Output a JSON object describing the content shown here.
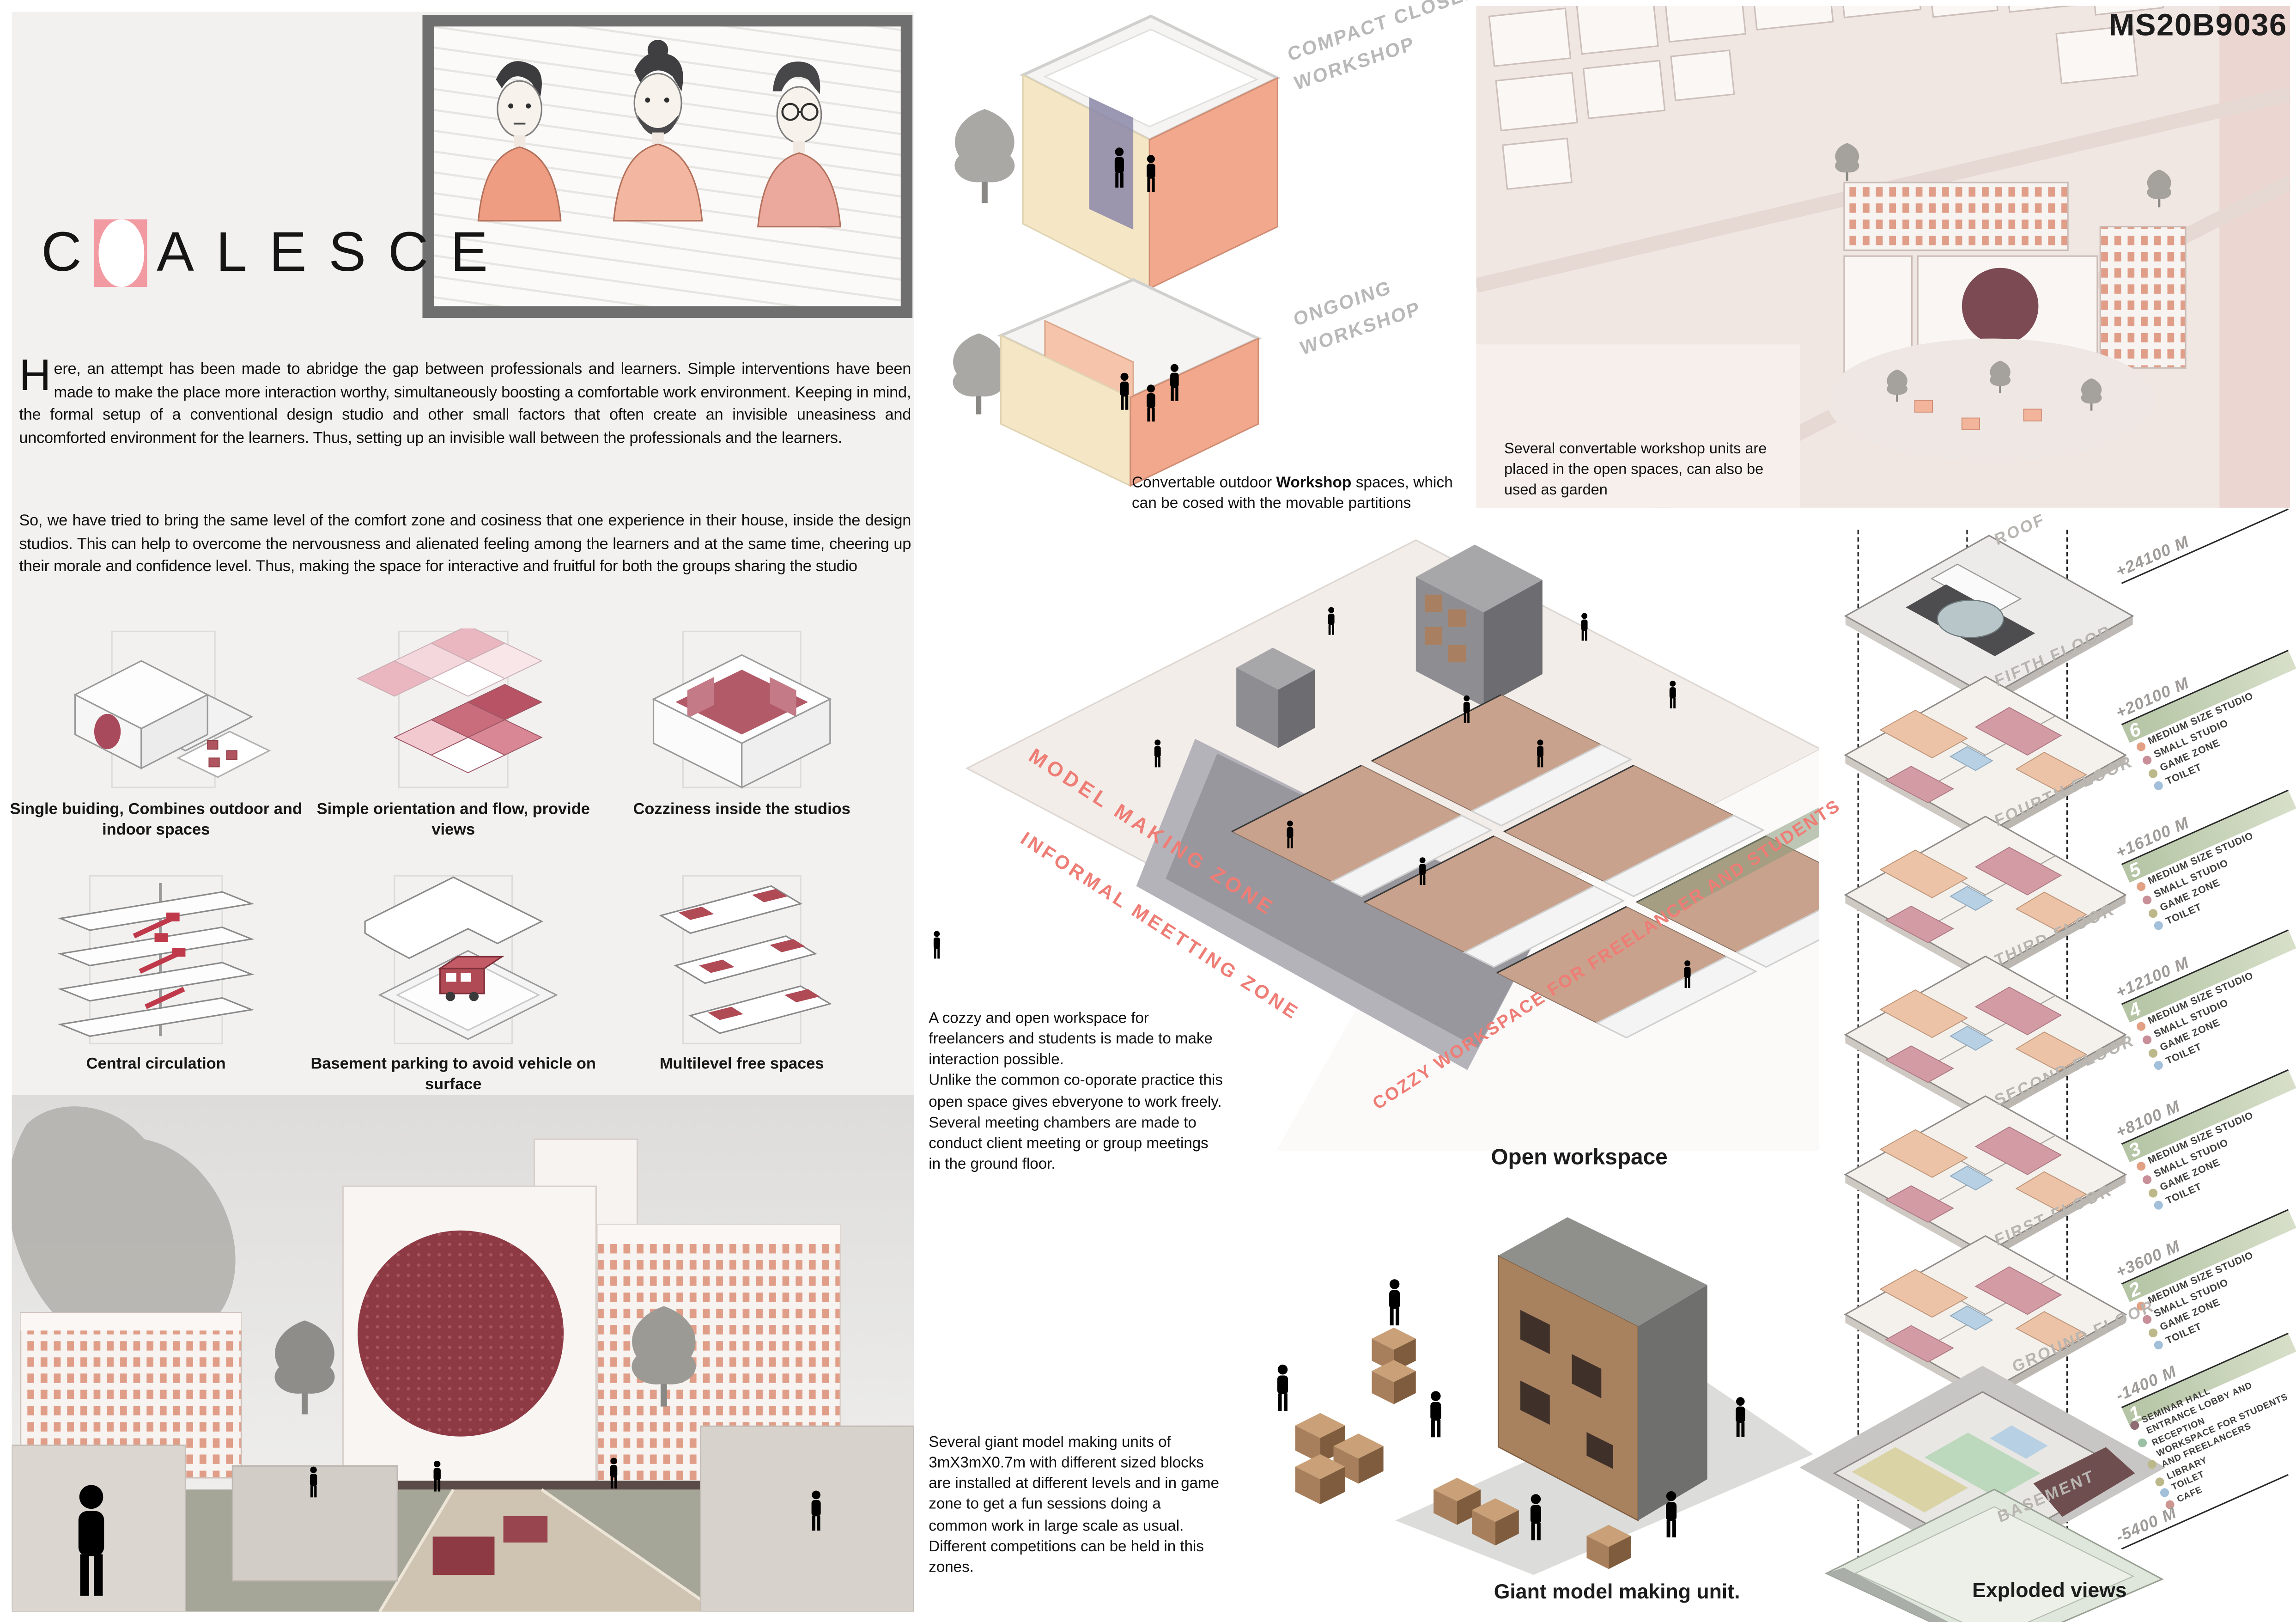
{
  "board": {
    "code": "MS20B9036"
  },
  "logo": {
    "first_letter": "C",
    "rest": "ALESCE"
  },
  "intro": {
    "drop_cap": "H",
    "p1": "ere, an attempt has been made to abridge the gap between professionals and learners. Simple interventions have been made to make the place more interaction worthy, simultaneously boosting a comfortable work environment. Keeping in mind, the formal setup of a conventional design studio and other small factors that often create an invisible uneasiness and uncomforted environment for the learners. Thus, setting up an invisible wall between the professionals and the learners.",
    "p2": "So, we have tried to bring the same level of the comfort zone and cosiness that one experience in their house, inside the design studios. This can help to overcome the nervousness and alienated feeling among the learners and at the same time, cheering up their morale and confidence level. Thus, making the space for interactive and fruitful for both the groups sharing the studio"
  },
  "concept_diagrams": [
    {
      "caption": "Single buiding, Combines outdoor and indoor spaces"
    },
    {
      "caption": "Simple orientation and flow, provide views"
    },
    {
      "caption": "Cozziness inside the studios"
    },
    {
      "caption": "Central circulation"
    },
    {
      "caption": "Basement parking to avoid vehicle on surface"
    },
    {
      "caption": "Multilevel free spaces"
    }
  ],
  "workshop": {
    "label_closed": "COMPACT CLOSED WORKSHOP",
    "label_ongoing": "ONGOING WORKSHOP",
    "caption_pre": "Convertable outdoor ",
    "caption_bold": "Workshop",
    "caption_post": " spaces, which can be cosed with the movable partitions"
  },
  "site": {
    "caption": "Several convertable workshop units are placed in the open spaces, can also be used as garden"
  },
  "open_workspace": {
    "title": "Open workspace",
    "caption": "A cozzy and open workspace for freelancers and students is made to make interaction possible.\nUnlike the common co-oporate practice this open space gives ebveryone to work freely. Several meeting chambers are made to conduct client meeting or group meetings in the ground floor.",
    "zones": {
      "model": "MODEL MAKING ZONE",
      "informal": "INFORMAL MEETTING ZONE",
      "cozzy": "COZZY WORKSPACE FOR FREELANCER AND STUDENTS"
    }
  },
  "model_unit": {
    "title": "Giant model making unit.",
    "caption": "Several giant model making units of 3mX3mX0.7m with different sized blocks are installed at different levels and in game zone to get a fun sessions doing a common work in large scale as usual.    Different competitions can be held in this zones."
  },
  "exploded": {
    "title": "Exploded views",
    "levels": [
      {
        "name": "ROOF",
        "elevation": "+24100 M",
        "number": "",
        "legend": []
      },
      {
        "name": "FIFTH FLOOR",
        "elevation": "+20100 M",
        "number": "6",
        "legend": [
          "MEDIUM SIZE STUDIO",
          "SMALL STUDIO",
          "GAME ZONE",
          "TOILET"
        ]
      },
      {
        "name": "FOURTH FLOOR",
        "elevation": "+16100 M",
        "number": "5",
        "legend": [
          "MEDIUM SIZE STUDIO",
          "SMALL STUDIO",
          "GAME ZONE",
          "TOILET"
        ]
      },
      {
        "name": "THIRD FLOOR",
        "elevation": "+12100 M",
        "number": "4",
        "legend": [
          "MEDIUM SIZE STUDIO",
          "SMALL STUDIO",
          "GAME ZONE",
          "TOILET"
        ]
      },
      {
        "name": "SECOND FLOOR",
        "elevation": "+8100 M",
        "number": "3",
        "legend": [
          "MEDIUM SIZE STUDIO",
          "SMALL STUDIO",
          "GAME ZONE",
          "TOILET"
        ]
      },
      {
        "name": "FIRST FLOOR",
        "elevation": "+3600 M",
        "number": "2",
        "legend": [
          "MEDIUM SIZE STUDIO",
          "SMALL STUDIO",
          "GAME ZONE",
          "TOILET"
        ]
      },
      {
        "name": "GROUND FLOOR",
        "elevation": "-1400 M",
        "number": "1",
        "legend": [
          "SEMINAR HALL",
          "ENTRANCE LOBBY AND RECEPTION",
          "WORKSPACE FOR STUDENTS AND FREELANCERS",
          "LIBRARY",
          "TOILET",
          "CAFE"
        ]
      },
      {
        "name": "BASEMENT",
        "elevation": "-5400 M",
        "number": "",
        "legend": []
      }
    ]
  },
  "colors": {
    "accent_pink": "#f29aa2",
    "annotation_red": "#ee7d76",
    "band_green": "#c2d0b0",
    "maroon": "#8e3a44",
    "legend_peach": "#e2a184",
    "legend_mauve": "#c98f99",
    "legend_olive": "#bdb88a",
    "legend_blue": "#a3c0da",
    "panel_gray": "#f2f1f0"
  }
}
